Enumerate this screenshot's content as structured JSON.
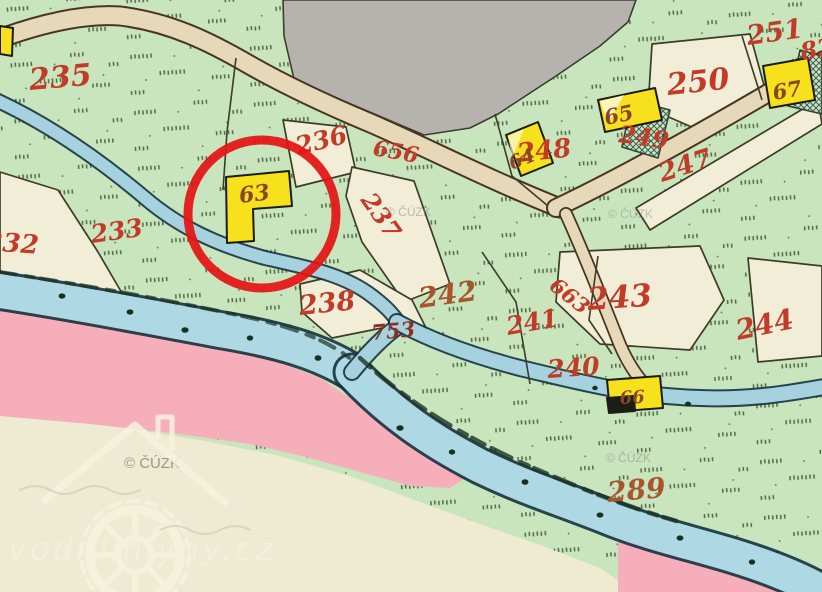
{
  "map": {
    "kind": "historical cadastral map scan",
    "labels": {
      "parcels": [
        "235",
        "232",
        "233",
        "236",
        "237",
        "238",
        "242",
        "241",
        "240",
        "243",
        "244",
        "248",
        "249",
        "250",
        "247",
        "251",
        "82",
        "289"
      ],
      "roads": [
        "656",
        "663"
      ],
      "water": [
        "753"
      ],
      "buildings": [
        "63",
        "64",
        "65",
        "66",
        "67"
      ]
    },
    "watermarks": {
      "copyright": "© ČÚZK",
      "site": "vodnimlyny.cz"
    },
    "annotation": {
      "highlight_circle_color": "#e41414",
      "highlighted_building": "63"
    },
    "colors": {
      "meadow_green": "#c8e5bd",
      "water_blue": "#a6d2e0",
      "parcel_cream": "#f2edd6",
      "built_grey": "#b6b3ae",
      "road_tan": "#e8d8ba",
      "floodplain_pink": "#f7aebb",
      "building_yellow": "#f6e11c",
      "parcel_number_red": "#c23a28"
    }
  }
}
